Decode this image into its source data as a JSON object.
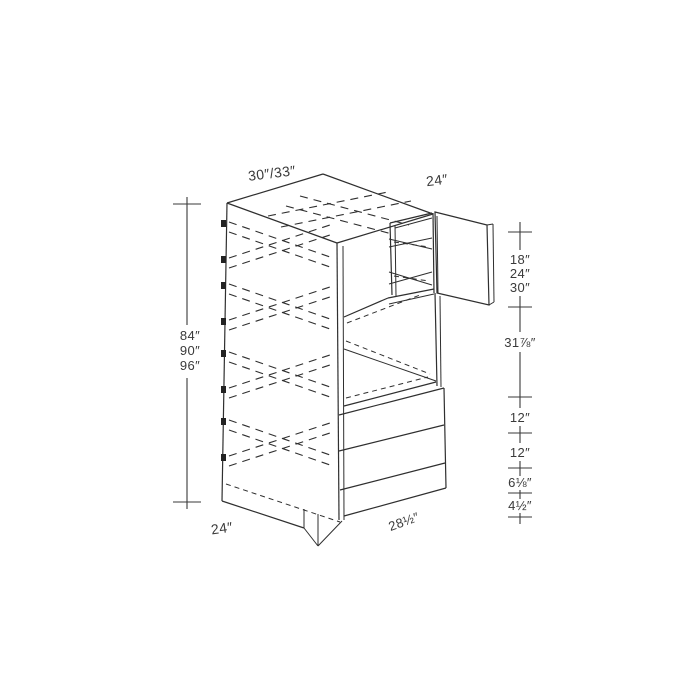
{
  "diagram": {
    "type": "cabinet-line-drawing",
    "description": "Double oven tall cabinet isometric drawing with dimension chains",
    "labels": {
      "top_width": "30″/33″",
      "top_depth": "24″",
      "left_heights": [
        "84″",
        "90″",
        "96″"
      ],
      "opening_heights": [
        "18″",
        "24″",
        "30″"
      ],
      "oven_opening": "31⅞″",
      "drawer_top": "12″",
      "drawer_middle": "12″",
      "drawer_bottom": "6⅛″",
      "toe_kick": "4½″",
      "bottom_depth": "24″",
      "bottom_width": "28½″"
    },
    "colors": {
      "line": "#2f2f2f",
      "text": "#3a3a3a",
      "background": "#ffffff"
    }
  }
}
